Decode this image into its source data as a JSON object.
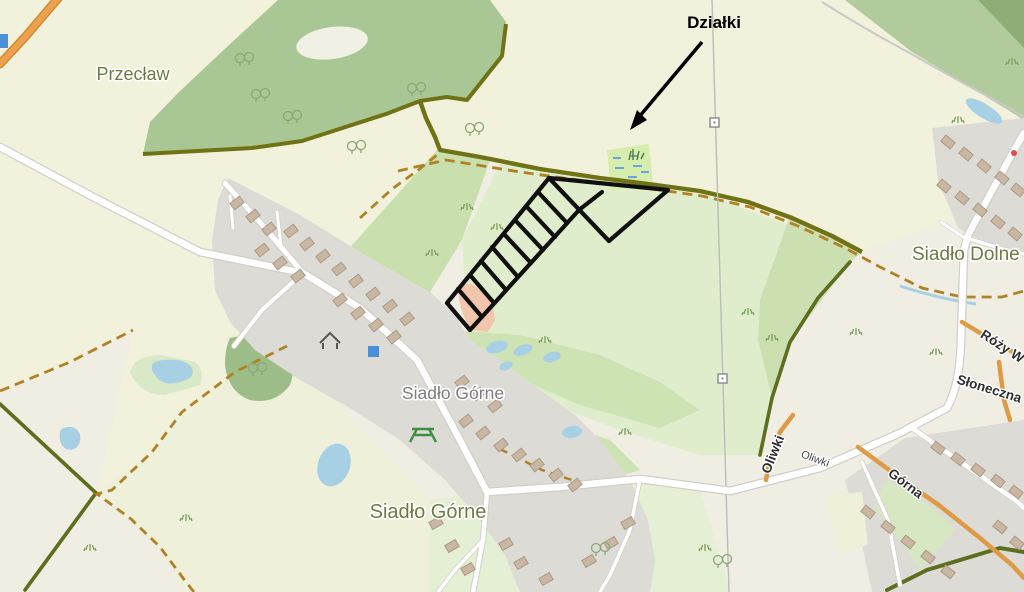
{
  "page": {
    "type": "map-screenshot",
    "description": "OpenStreetMap-style map of Siadło Górne area with hand-drawn parcel sketch annotated 'Działki'"
  },
  "labels": {
    "przeclaw": "Przecław",
    "siadlo_gorne_upper": "Siadło Górne",
    "siadlo_gorne_lower": "Siadło Górne",
    "siadlo_dolne": "Siadło Dolne",
    "dzialki": "Działki",
    "street_oliwki": "Oliwki",
    "street_oliwki_minor": "Oliwki",
    "street_gorna": "Górna",
    "street_rozy": "Róży W",
    "street_sloneczna": "Słoneczna"
  },
  "colors": {
    "background_beige": "#f0ede2",
    "field_pale": "#f1f1dc",
    "field_light_green": "#e4efd3",
    "field_medium_green": "#cde3b3",
    "forest_green": "#a9c795",
    "forest_dark": "#8fae77",
    "village_gray": "#dcdbd6",
    "building_fill": "#c9b7a3",
    "building_outline": "#ab9a82",
    "water_blue": "#a8d0e4",
    "wetland_fill": "#d6edad",
    "wetland_dash_blue": "#6aa3dd",
    "road_white": "#ffffff",
    "road_casing": "#d2cfca",
    "road_orange": "#de9b45",
    "boundary_olive": "#6f7316",
    "track_dash_brown": "#b08226",
    "hedge_dark_olive": "#5d6e1e",
    "pink_area": "#f2c6ac",
    "annotation_black": "#101010",
    "marker_blue": "#4a90d9",
    "label_olive": "#6b7c42",
    "label_gray": "#7d7d7d"
  },
  "icons": {
    "picnic_table": "picnic-table-icon",
    "shelter": "shelter-icon",
    "power_pole": "power-pole-icon",
    "arrow": "annotation-arrow-icon",
    "tree": "tree-icon",
    "grass": "grass-tuft-icon"
  }
}
